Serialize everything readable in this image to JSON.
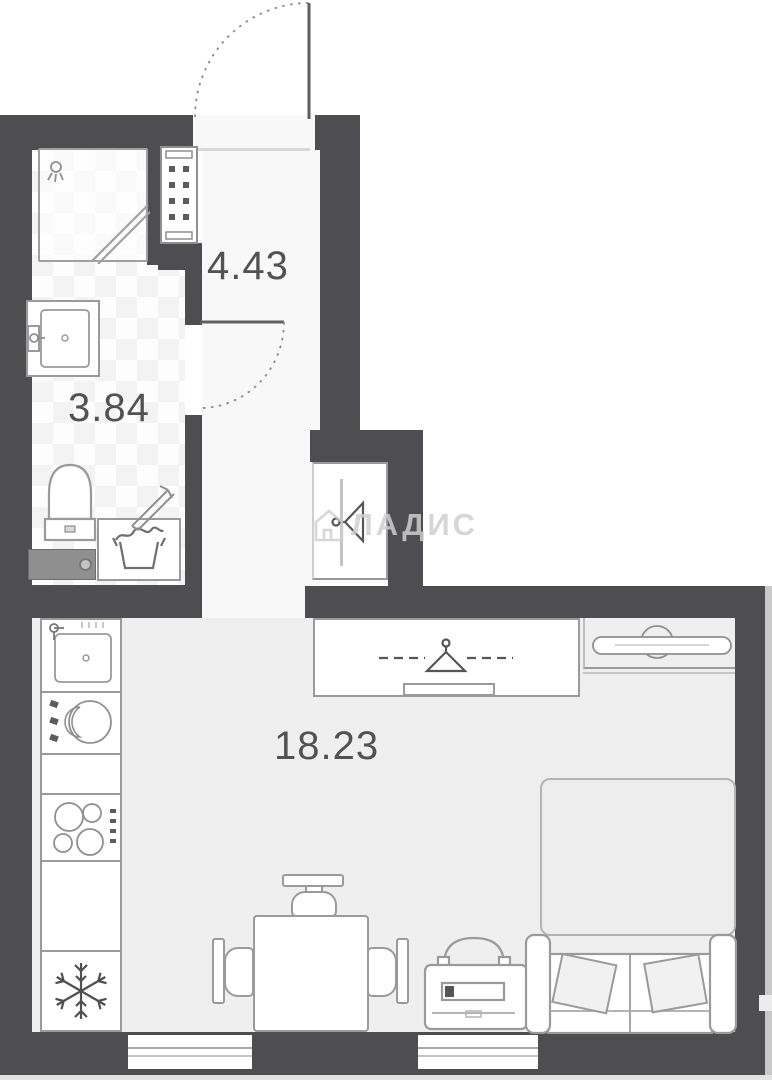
{
  "title": "apartment-floor-plan",
  "rooms": {
    "hallway": {
      "name": "hallway",
      "area": "4.43"
    },
    "bathroom": {
      "name": "bathroom",
      "area": "3.84"
    },
    "living_room": {
      "name": "living-kitchen room",
      "area": "18.23"
    }
  },
  "watermark": {
    "brand": "ЛАДИС",
    "icon": "house-icon"
  },
  "colors": {
    "wall": "#4e4e50",
    "floor_living": "#efefef",
    "floor_hall": "#f8f8f8",
    "furniture_line": "#9a9a9a",
    "label_text": "#525252",
    "watermark": "#cfcfcf"
  },
  "icons": {
    "entrance_door": "door-swing-arc",
    "bathroom_door": "door-swing-arc",
    "shower": "shower-head-icon",
    "vent": "vent-shaft-hatch",
    "wardrobe": "clothes-hanger-icon",
    "tv": "tv-on-stand-icon",
    "fridge": "snowflake-icon",
    "laundry": "laundry-basket-icon"
  }
}
